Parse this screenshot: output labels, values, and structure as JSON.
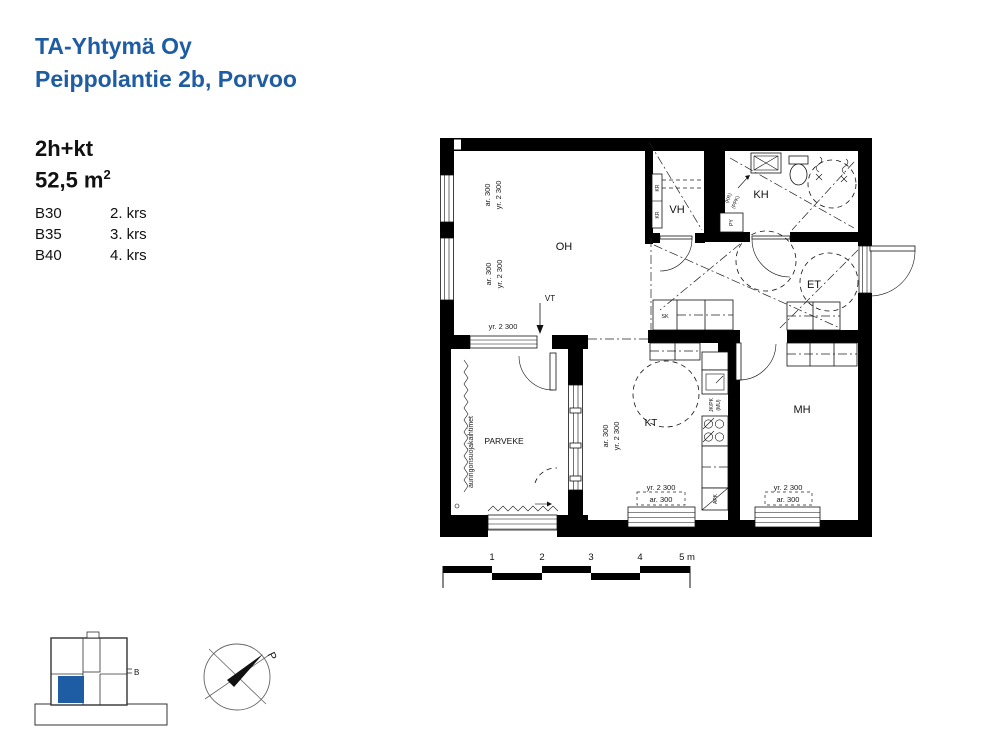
{
  "header": {
    "company": "TA-Yhtymä Oy",
    "address": "Peippolantie 2b, Porvoo"
  },
  "apartment": {
    "type": "2h+kt",
    "area_value": "52,5 m",
    "area_exponent": "2",
    "units": [
      {
        "id": "B30",
        "floor": "2. krs"
      },
      {
        "id": "B35",
        "floor": "3. krs"
      },
      {
        "id": "B40",
        "floor": "4. krs"
      }
    ]
  },
  "plan": {
    "rooms": {
      "oh": "OH",
      "vh": "VH",
      "kh": "KH",
      "et": "ET",
      "kt": "KT",
      "mh": "MH",
      "parveke": "PARVEKE"
    },
    "labels": {
      "vt": "VT",
      "sk": "SK",
      "py": "PY",
      "kr": "KR",
      "kr_reservation": "(KR)",
      "ppk_reservation": "(PPK)",
      "fridge": "JK/PK",
      "microwave": "(MU)",
      "dishwasher": "APK",
      "blinds": "auringonsuojakaihtimet"
    },
    "dims": {
      "ar_300": "ar. 300",
      "yr_2300": "yr. 2 300"
    }
  },
  "scalebar": {
    "labels": [
      "1",
      "2",
      "3",
      "4",
      "5 m"
    ]
  },
  "keyplan": {
    "building_label": "B"
  },
  "compass": {
    "north": "P"
  },
  "colors": {
    "brand_blue": "#1e5ca3",
    "ink": "#111111"
  }
}
